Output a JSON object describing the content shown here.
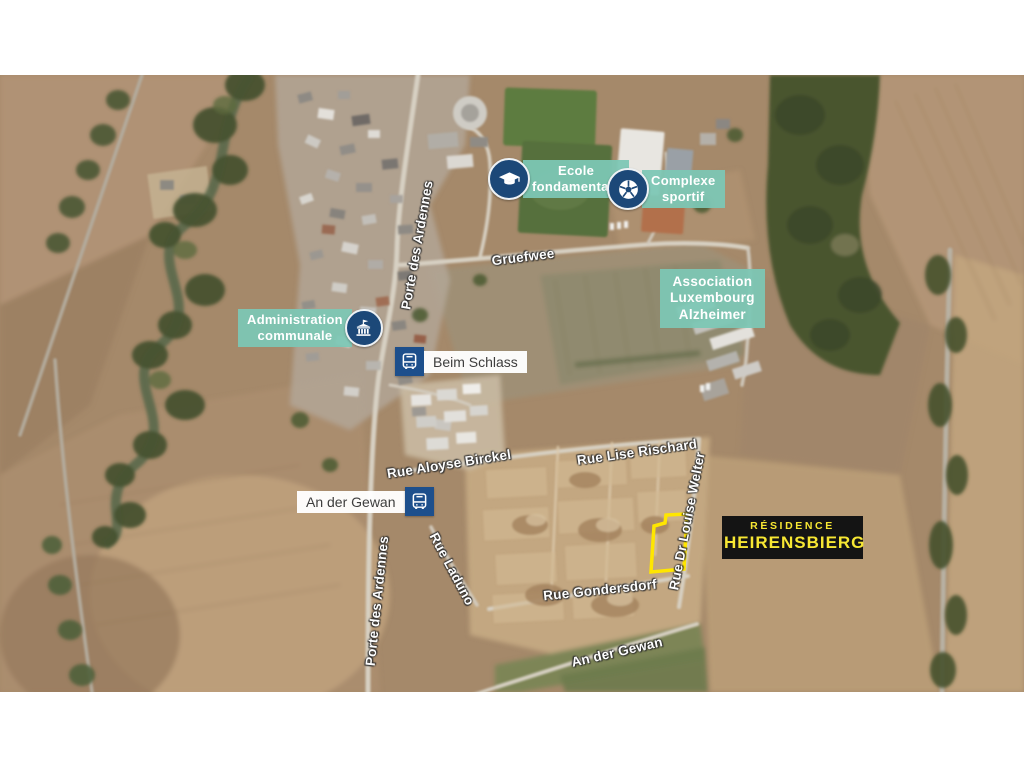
{
  "map": {
    "poi": [
      {
        "id": "ecole-fondamentale",
        "icon": "graduation-cap",
        "lines": [
          "Ecole",
          "fondamentale"
        ]
      },
      {
        "id": "complexe-sportif",
        "icon": "soccer-ball",
        "lines": [
          "Complexe",
          "sportif"
        ]
      },
      {
        "id": "association-luxembourg-alzheimer",
        "icon": "none",
        "lines": [
          "Association",
          "Luxembourg",
          "Alzheimer"
        ]
      },
      {
        "id": "administration-communale",
        "icon": "town-hall",
        "lines": [
          "Administration",
          "communale"
        ]
      }
    ],
    "bus_stops": [
      {
        "name": "Beim Schlass"
      },
      {
        "name": "An der Gewan"
      }
    ],
    "streets": [
      {
        "text": "Porte des Ardennes"
      },
      {
        "text": "Gruefwee"
      },
      {
        "text": "Rue Aloyse Birckel"
      },
      {
        "text": "Rue Lise Rischard"
      },
      {
        "text": "Rue Dr Louise Welter"
      },
      {
        "text": "Rue Laduno"
      },
      {
        "text": "Rue Gondersdorf"
      },
      {
        "text": "An der Gewan"
      },
      {
        "text": "Porte des Ardennes"
      }
    ],
    "residence": {
      "line1": "RÉSIDENCE",
      "line2": "HEIRENSBIERG"
    }
  },
  "colors": {
    "poi_badge_teal": "#7cc7b5",
    "poi_icon_navy": "#1c4878",
    "bus_blue": "#1d4f8c",
    "bus_label_text": "#3d3d3d",
    "residence_bg": "#141414",
    "residence_text": "#f7e733",
    "plot_outline": "#ffe600",
    "street_text": "#ffffff"
  }
}
